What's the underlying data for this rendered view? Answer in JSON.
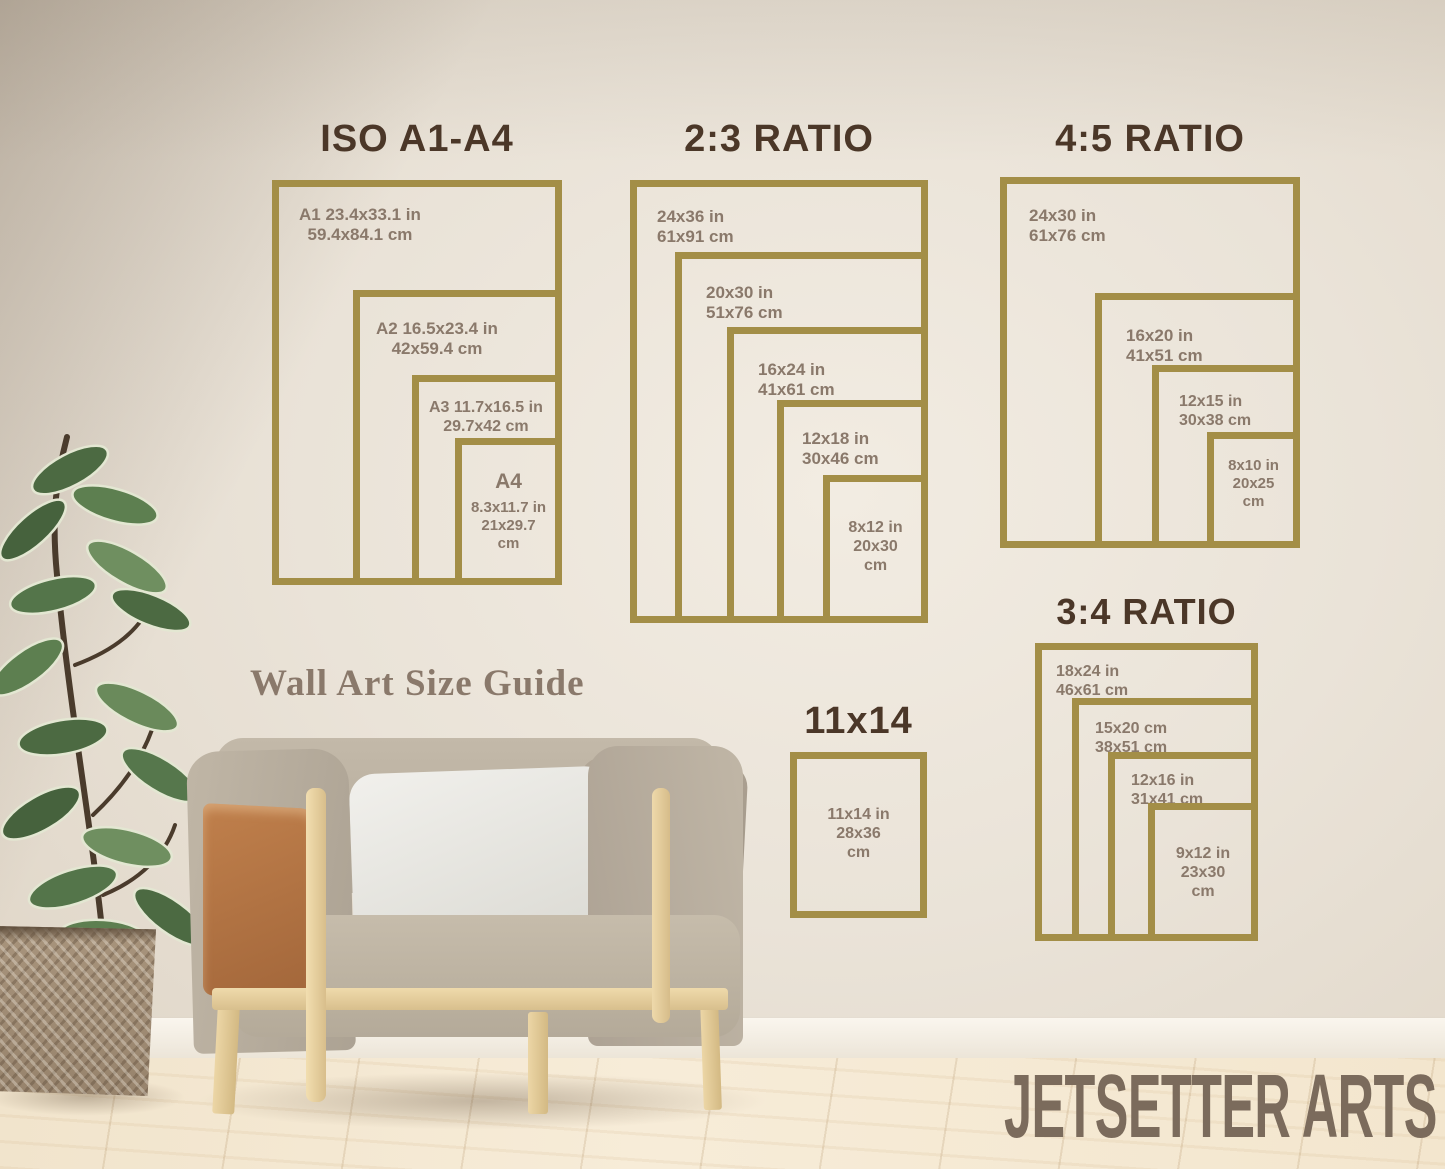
{
  "guide_title": "Wall Art Size Guide",
  "brand": "JETSETTER ARTS",
  "colors": {
    "frame_gold": "#a38e47",
    "title_brown": "#4b3728",
    "label_gray_brown": "#8a796b",
    "wall_beige": "#eae3d8",
    "brand_brown": "#7b6b5c"
  },
  "panels": [
    {
      "title": "ISO A1-A4",
      "frames": [
        {
          "line1": "A1 23.4x33.1 in",
          "line2": "59.4x84.1 cm"
        },
        {
          "line1": "A2 16.5x23.4 in",
          "line2": "42x59.4 cm"
        },
        {
          "line1": "A3 11.7x16.5 in",
          "line2": "29.7x42 cm"
        },
        {
          "big": "A4",
          "line1": "8.3x11.7 in",
          "line2": "21x29.7",
          "line3": "cm"
        }
      ]
    },
    {
      "title": "2:3 RATIO",
      "frames": [
        {
          "line1": "24x36 in",
          "line2": "61x91 cm"
        },
        {
          "line1": "20x30 in",
          "line2": "51x76 cm"
        },
        {
          "line1": "16x24 in",
          "line2": "41x61 cm"
        },
        {
          "line1": "12x18 in",
          "line2": "30x46 cm"
        },
        {
          "line1": "8x12 in",
          "line2": "20x30",
          "line3": "cm"
        }
      ]
    },
    {
      "title": "4:5 RATIO",
      "frames": [
        {
          "line1": "24x30 in",
          "line2": "61x76 cm"
        },
        {
          "line1": "16x20 in",
          "line2": "41x51 cm"
        },
        {
          "line1": "12x15 in",
          "line2": "30x38 cm"
        },
        {
          "line1": "8x10 in",
          "line2": "20x25",
          "line3": "cm"
        }
      ]
    },
    {
      "title": "3:4 RATIO",
      "frames": [
        {
          "line1": "18x24 in",
          "line2": "46x61 cm"
        },
        {
          "line1": "15x20 cm",
          "line2": "38x51 cm"
        },
        {
          "line1": "12x16 in",
          "line2": "31x41 cm"
        },
        {
          "line1": "9x12 in",
          "line2": "23x30",
          "line3": "cm"
        }
      ]
    },
    {
      "title": "11x14",
      "frames": [
        {
          "line1": "11x14 in",
          "line2": "28x36",
          "line3": "cm"
        }
      ]
    }
  ]
}
